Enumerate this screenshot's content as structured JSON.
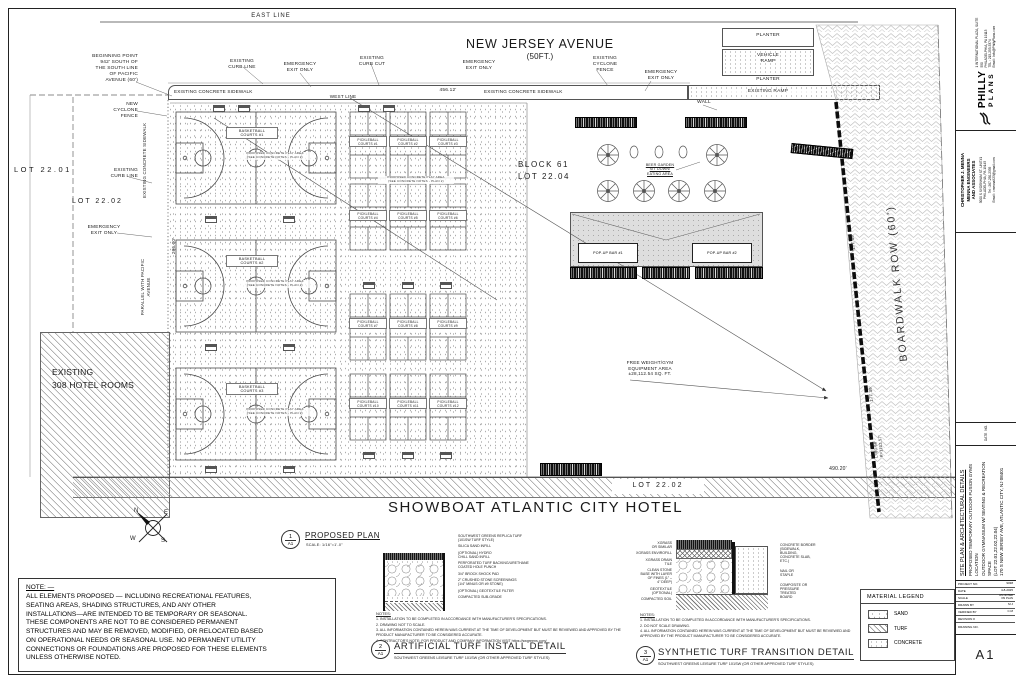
{
  "plan": {
    "east_line": "EAST LINE",
    "street_name": "NEW JERSEY AVENUE",
    "street_width": "(50FT.)",
    "beginning_point": "BEGINNING POINT\n942' SOUTH OF\nTHE SOUTH LINE\nOF PACIFIC\nAVENUE (60')",
    "existing_curb_line": "EXISTING\nCURB LINE",
    "emergency_exit": "EMERGENCY\nEXIT ONLY",
    "existing_curb_cut": "EXISTING\nCURB CUT",
    "existing_cyclone_fence": "EXISTING\nCYCLONE\nFENCE",
    "sidewalk": "EXISTING CONCRETE SIDEWALK",
    "west_line": "WEST LINE",
    "dim_top": "456.12'",
    "new_cyclone_fence": "NEW\nCYCLONE\nFENCE",
    "lot_2201": "LOT 22.01",
    "lot_2202": "LOT 22.02",
    "sidewalk_vertical": "EXISTING CONCRETE SIDEWALK",
    "parallel_pacific": "PARALLEL WITH PACIFIC\nAVENUE",
    "dim_left": "206.00'",
    "planter_top": "PLANTER",
    "vehicle_ramp": "VEHICLE\nRAMP",
    "planter_bottom": "PLANTER",
    "existing_ramp": "EXISTING RAMP",
    "wall": "WALL",
    "block61": "BLOCK 61\nLOT 22.04",
    "beer_garden": "BEER GARDEN\nSIT DOWN/\nEATING AREA",
    "popup_bar_1": "POP-UP BAR #1",
    "popup_bar_2": "POP-UP BAR #2",
    "free_weight": "FREE WEIGHT/GYM\nEQUIPMENT AREA\n±28,112.54 SQ. FT.",
    "lot_2202_bottom": "LOT 22.02",
    "hotel_rooms": "EXISTING\n308 HOTEL ROOMS",
    "showboat": "SHOWBOAT ATLANTIC CITY HOTEL",
    "dim_bottom": "490.20'",
    "boardwalk": "BOARDWALK ROW (60')",
    "dim_boardwalk_1": "177.39'",
    "dim_boardwalk_2": "177.39'",
    "dim_boardwalk_3": "L=90.99'\nR=1102.57'",
    "court_note": "PROPOSED CONCRETE PLAY AREA\n(SEE CONCRETE NOTES - PLAN 2)",
    "basketball_courts": [
      {
        "label": "BASKETBALL\nCOURTS #1"
      },
      {
        "label": "BASKETBALL\nCOURTS #2"
      },
      {
        "label": "BASKETBALL\nCOURTS #3"
      }
    ],
    "pickleball_courts": [
      {
        "label": "PICKLEBALL\nCOURTS #1"
      },
      {
        "label": "PICKLEBALL\nCOURTS #2"
      },
      {
        "label": "PICKLEBALL\nCOURTS #3"
      },
      {
        "label": "PICKLEBALL\nCOURTS #4"
      },
      {
        "label": "PICKLEBALL\nCOURTS #5"
      },
      {
        "label": "PICKLEBALL\nCOURTS #6"
      },
      {
        "label": "PICKLEBALL\nCOURTS #7"
      },
      {
        "label": "PICKLEBALL\nCOURTS #8"
      },
      {
        "label": "PICKLEBALL\nCOURTS #9"
      },
      {
        "label": "PICKLEBALL\nCOURTS #10"
      },
      {
        "label": "PICKLEBALL\nCOURTS #11"
      },
      {
        "label": "PICKLEBALL\nCOURTS #12"
      }
    ],
    "compass": {
      "n": "N",
      "e": "E",
      "s": "S",
      "w": "W"
    },
    "proposed_plan": {
      "num": "1",
      "sheet": "A1",
      "title": "PROPOSED PLAN",
      "scale": "SCALE: 1/16\"=1'-0\""
    }
  },
  "note_box": {
    "title": "NOTE: —",
    "body": "ALL ELEMENTS PROPOSED — INCLUDING RECREATIONAL FEATURES,\nSEATING AREAS, SHADING STRUCTURES, AND ANY OTHER\nINSTALLATIONS—ARE INTENDED TO BE TEMPORARY OR SEASONAL.\nTHESE COMPONENTS ARE NOT TO BE CONSIDERED PERMANENT\nSTRUCTURES AND MAY BE REMOVED, MODIFIED, OR RELOCATED BASED\nON OPERATIONAL NEEDS OR SEASONAL USE. NO PERMANENT UTILITY\nCONNECTIONS OR FOUNDATIONS ARE PROPOSED FOR THESE ELEMENTS\nUNLESS OTHERWISE NOTED."
  },
  "detail_turf": {
    "num": "2",
    "sheet_ref": "A1",
    "title": "ARTIFICIAL TURF INSTALL DETAIL",
    "subtitle": "SOUTHWEST GREENS LEISURE TURF 101SW (OR OTHER APPROVED TURF STYLES)",
    "callouts": [
      "SOUTHWEST GREENS REPLICA TURF\n(101SW TURF STYLE)",
      "SILICA SAND INFILL",
      "(OPTIONAL) HYDRO\nCHILL SAND INFILL",
      "PERFORATED TURF BACKING/URETHANE\nCOATED HOLE PUNCH",
      "3/4\" BROCK SHOCK PAD",
      "2\" CRUSHED STONE SCREENINGS\n(1/4\" MINUS OR #9 STONE)",
      "(OPTIONAL) GEOTEXTILE FILTER",
      "COMPACTED SUB-GRADE"
    ],
    "notes_title": "NOTES:",
    "notes": [
      "1.   INSTALLATION TO BE COMPLETED IN ACCORDANCE WITH MANUFACTURER'S SPECIFICATIONS.",
      "2.   DRAWING NOT TO SCALE.",
      "3.   ALL INFORMATION CONTAINED HEREIN WAS CURRENT AT THE TIME OF DEVELOPMENT BUT MUST BE REVIEWED AND APPROVED BY THE PRODUCT MANUFACTURER TO BE CONSIDERED ACCURATE.",
      "4.   CONTRACTOR'S NOTE: FOR PRODUCT AND COMPANY INFORMATION VISIT  https://swgreens.com/"
    ]
  },
  "detail_transition": {
    "num": "3",
    "sheet_ref": "A1",
    "title": "SYNTHETIC TURF TRANSITION DETAIL",
    "subtitle": "SOUTHWEST GREENS LEISURE TURF 101SW (OR OTHER APPROVED TURF STYLES)",
    "callouts_left": [
      "XGRASS\nOR SIMILAR",
      "XGRASS ENVIROFILL",
      "XGRASS DRAIN\nTILE",
      "CLEAN STONE\nBASE WITH LAYER\nOF FINES (1\" –\n4\" DEEP)",
      "GEOTEXTILE\n(OPTIONAL)",
      "COMPACTED SOIL"
    ],
    "callouts_right": [
      "CONCRETE BORDER\n(SIDEWALK,\nBUILDING,\nCONCRETE SLAB,\nETC.)",
      "NAIL OR\nSTAPLE",
      "COMPOSITE OR\nPRESSURE\nTREATED\nBOARD"
    ],
    "notes_title": "NOTES:",
    "notes": [
      "1.   INSTALLATION TO BE COMPLETED IN ACCORDANCE WITH MANUFACTURER'S SPECIFICATIONS.",
      "2.   DO NOT SCALE DRAWING.",
      "4.   ALL INFORMATION CONTAINED HEREIN WAS CURRENT AT THE TIME OF DEVELOPMENT BUT MUST BE REVIEWED AND APPROVED BY THE PRODUCT MANUFACTURER TO BE CONSIDERED ACCURATE."
    ]
  },
  "legend": {
    "title": "MATERIAL LEGEND",
    "items": [
      {
        "label": "SAND"
      },
      {
        "label": "TURF"
      },
      {
        "label": "CONCRETE"
      }
    ]
  },
  "titleblock": {
    "firm1_brand_top": "PHILLY",
    "firm1_brand_bottom": "PLANS",
    "firm1_info": "1 INTERNATIONAL PLAZA, SUITE 550\nPHILADELPHIA, PA 19113\nTEL : 215-253-5374\nEmail : Info@PhillyPlans.com",
    "firm2_name": "CHRISTOPHER J. MENNA\nMENNA ENGINEERS\nAND ASSOCIATES",
    "firm2_info": "3000 S SYDENHAM ST. UNIT#1\nPHILADELPHIA, PA 19145\nTel : 267-250-2335\nEmail : cmenna923@gmail.com",
    "rev_date": "DATE",
    "rev_no": "NO.",
    "title1": "SITE PLAN & ARCHITECTURAL DETAILS",
    "title2": "PROPOSED TEMPORARY OUTDOOR FUSION GYMS LOCATION\nOUTDOOR GYMNASIUM W/ SEATING & RECREATION SPACE",
    "title3": "(LOT 22.01,22.02,22.04)\n170 S NEW JERSEY AVE, ATLANTIC CITY, NJ 08401",
    "project_rows": [
      {
        "k": "PROJECT NO.",
        "v": "9038"
      },
      {
        "k": "DATE",
        "v": "4-8-2025"
      },
      {
        "k": "SCALE",
        "v": "AS NOTED\nON PLAN"
      },
      {
        "k": "DRAWN BY",
        "v": "M.J"
      },
      {
        "k": "VERIFIED BY",
        "v": "C.M"
      },
      {
        "k": "REVISION #",
        "v": ""
      },
      {
        "k": "DRAWING NO.",
        "v": ""
      }
    ],
    "sheet_no": "A1"
  }
}
